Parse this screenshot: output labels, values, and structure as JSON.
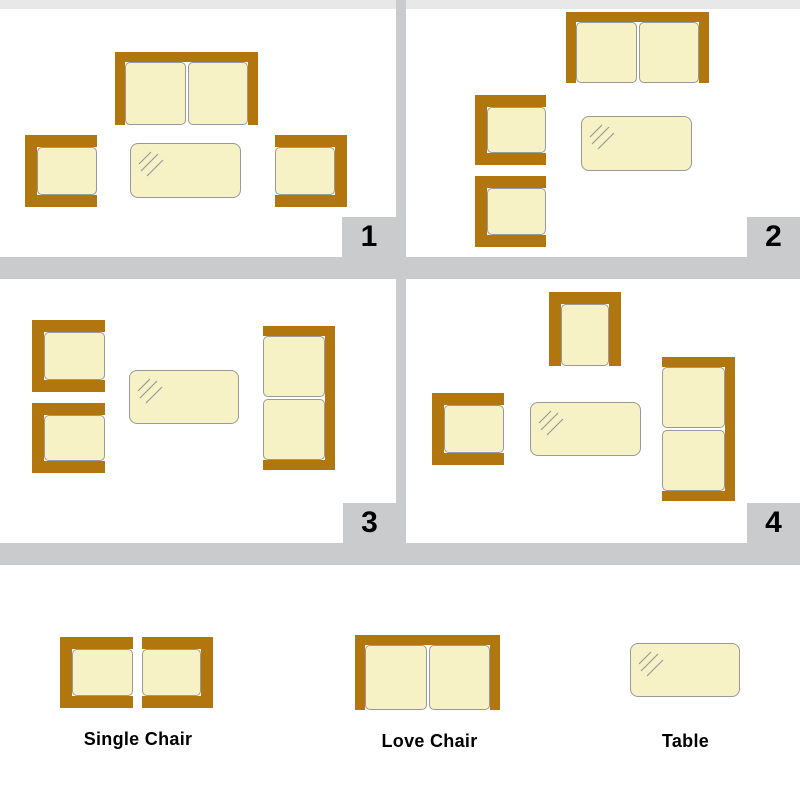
{
  "colors": {
    "wood": "#B1760D",
    "cushion": "#F6F2C6",
    "outline": "#999999",
    "divider": "#C9CBCC",
    "footer_strip": "#E8E8E8",
    "text": "#000000"
  },
  "layouts": [
    {
      "number": "1",
      "furniture": [
        {
          "type": "love",
          "open": "bottom",
          "x": 115,
          "y": 52,
          "w": 143,
          "h": 73
        },
        {
          "type": "single",
          "open": "right",
          "x": 25,
          "y": 135,
          "w": 72,
          "h": 72
        },
        {
          "type": "table",
          "x": 130,
          "y": 143,
          "w": 111,
          "h": 55
        },
        {
          "type": "single",
          "open": "left",
          "x": 275,
          "y": 135,
          "w": 72,
          "h": 72
        }
      ]
    },
    {
      "number": "2",
      "furniture": [
        {
          "type": "love",
          "open": "bottom",
          "x": 566,
          "y": 12,
          "w": 143,
          "h": 71
        },
        {
          "type": "single",
          "open": "right",
          "x": 475,
          "y": 95,
          "w": 71,
          "h": 70
        },
        {
          "type": "single",
          "open": "right",
          "x": 475,
          "y": 176,
          "w": 71,
          "h": 71
        },
        {
          "type": "table",
          "x": 581,
          "y": 116,
          "w": 111,
          "h": 55
        }
      ]
    },
    {
      "number": "3",
      "furniture": [
        {
          "type": "single",
          "open": "right",
          "x": 32,
          "y": 320,
          "w": 73,
          "h": 72
        },
        {
          "type": "single",
          "open": "right",
          "x": 32,
          "y": 403,
          "w": 73,
          "h": 70
        },
        {
          "type": "table",
          "x": 129,
          "y": 370,
          "w": 110,
          "h": 54
        },
        {
          "type": "love",
          "open": "left",
          "x": 263,
          "y": 326,
          "w": 72,
          "h": 144
        }
      ]
    },
    {
      "number": "4",
      "furniture": [
        {
          "type": "single",
          "open": "bottom",
          "x": 549,
          "y": 292,
          "w": 72,
          "h": 74
        },
        {
          "type": "single",
          "open": "right",
          "x": 432,
          "y": 393,
          "w": 72,
          "h": 72
        },
        {
          "type": "table",
          "x": 530,
          "y": 402,
          "w": 111,
          "h": 54
        },
        {
          "type": "love",
          "open": "left",
          "x": 662,
          "y": 357,
          "w": 73,
          "h": 144
        }
      ]
    }
  ],
  "legend": {
    "items": [
      {
        "label": "Single Chair",
        "icons": [
          {
            "type": "single",
            "open": "right",
            "x": 60,
            "y": 637,
            "w": 73,
            "h": 71
          },
          {
            "type": "single",
            "open": "left",
            "x": 142,
            "y": 637,
            "w": 71,
            "h": 71
          }
        ]
      },
      {
        "label": "Love Chair",
        "icons": [
          {
            "type": "love",
            "open": "bottom",
            "x": 355,
            "y": 635,
            "w": 145,
            "h": 75
          }
        ]
      },
      {
        "label": "Table",
        "icons": [
          {
            "type": "table",
            "x": 630,
            "y": 643,
            "w": 110,
            "h": 54
          }
        ]
      }
    ]
  }
}
